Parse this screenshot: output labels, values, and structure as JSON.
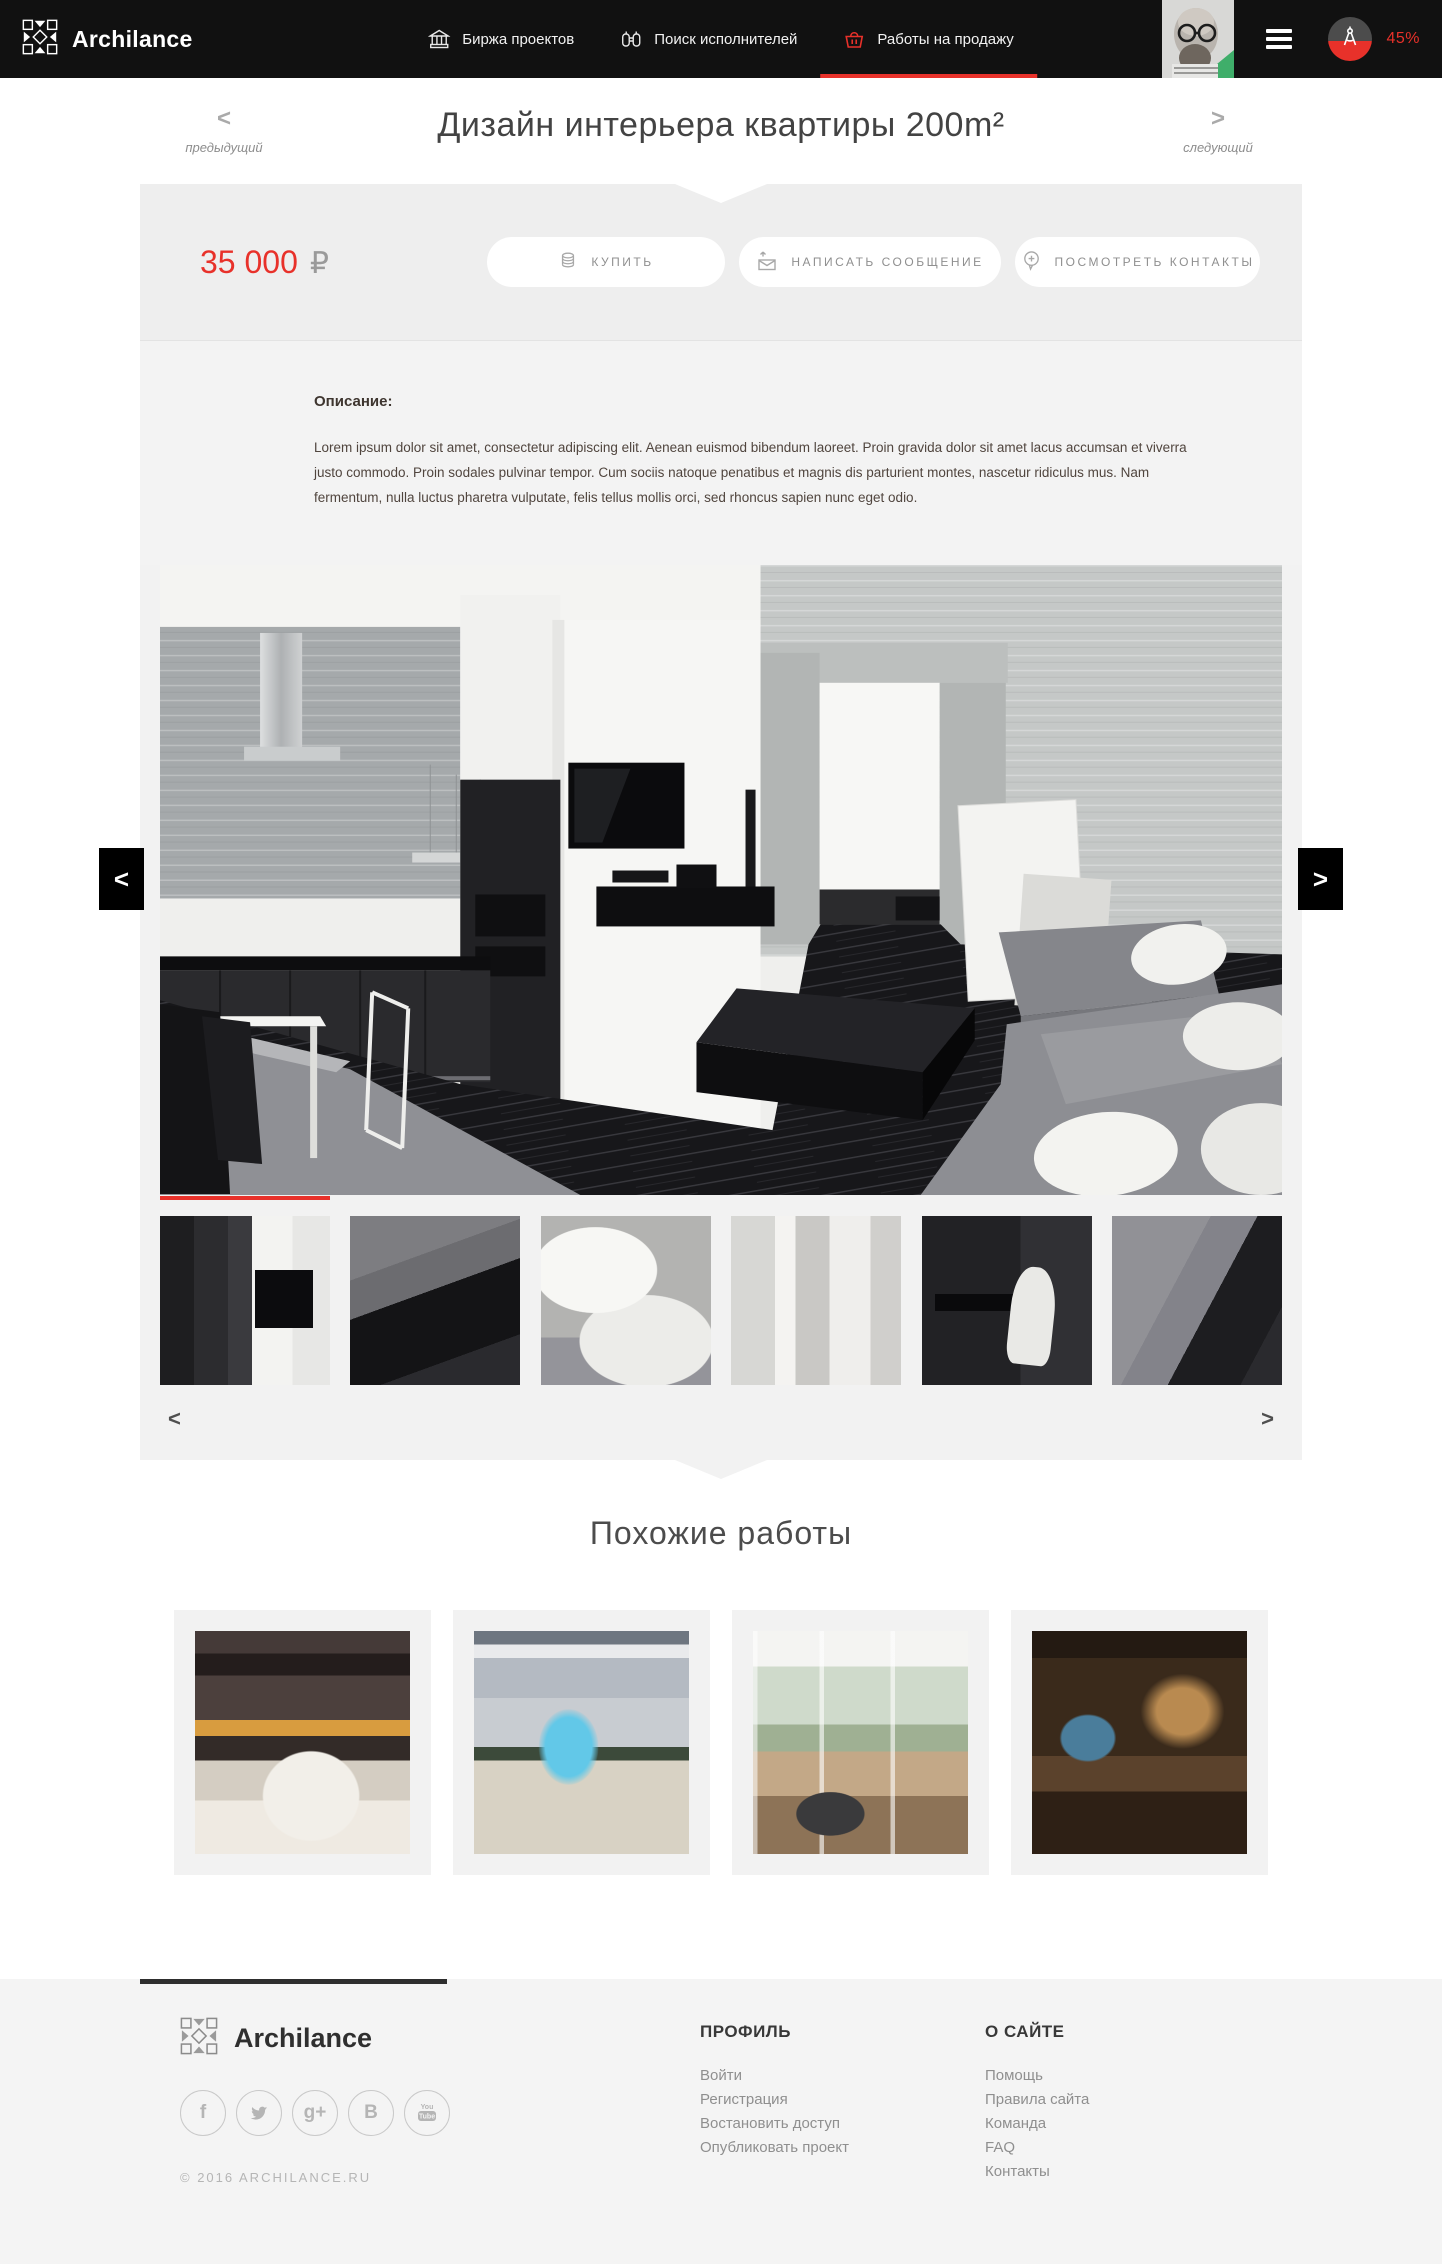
{
  "header": {
    "brand": "Archilance",
    "nav": [
      {
        "label": "Биржа проектов",
        "icon": "bank-icon"
      },
      {
        "label": "Поиск исполнителей",
        "icon": "binoculars-icon"
      },
      {
        "label": "Работы на продажу",
        "icon": "basket-icon"
      }
    ],
    "active_nav": "Работы на продажу",
    "progress_percent": "45%"
  },
  "work": {
    "title": "Дизайн интерьера квартиры 200m²",
    "prev_arrow": "<",
    "prev_label": "предыдущий",
    "next_arrow": ">",
    "next_label": "следующий",
    "price": "35 000",
    "currency": "₽",
    "buy_button": "КУПИТЬ",
    "message_button": "НАПИСАТЬ СООБЩЕНИЕ",
    "contacts_button": "ПОСМОТРЕТЬ КОНТАКТЫ",
    "description_heading": "Описание:",
    "description_text": "Lorem ipsum dolor sit amet, consectetur adipiscing elit. Aenean euismod bibendum laoreet. Proin gravida dolor sit amet lacus accumsan et viverra justo commodo. Proin sodales pulvinar tempor. Cum sociis natoque penatibus et magnis dis parturient montes, nascetur ridiculus mus. Nam fermentum, nulla luctus pharetra vulputate, felis tellus mollis orci, sed rhoncus sapien nunc eget odio."
  },
  "gallery": {
    "prev_button": "<",
    "next_button": ">",
    "thumb_prev": "<",
    "thumb_next": ">",
    "thumbnail_count": 6,
    "active_thumbnail": 1
  },
  "similar": {
    "heading": "Похожие работы",
    "cards": [
      "interior-fireplace",
      "mall-atrium",
      "bright-living-room",
      "library-room"
    ]
  },
  "footer": {
    "brand": "Archilance",
    "copyright": "© 2016 ARCHILANCE.RU",
    "socials": [
      {
        "name": "facebook",
        "glyph": "f"
      },
      {
        "name": "twitter",
        "glyph": ""
      },
      {
        "name": "google-plus",
        "glyph": "g+"
      },
      {
        "name": "vk",
        "glyph": "B"
      },
      {
        "name": "youtube",
        "glyph": ""
      }
    ],
    "columns": [
      {
        "title": "ПРОФИЛЬ",
        "links": [
          "Войти",
          "Регистрация",
          "Востановить доступ",
          "Опубликовать проект"
        ]
      },
      {
        "title": "О САЙТЕ",
        "links": [
          "Помощь",
          "Правила сайта",
          "Команда",
          "FAQ",
          "Контакты"
        ]
      }
    ]
  },
  "colors": {
    "accent_red": "#e8312a",
    "header_bg": "#111111",
    "panel_gray": "#f2f2f2"
  }
}
